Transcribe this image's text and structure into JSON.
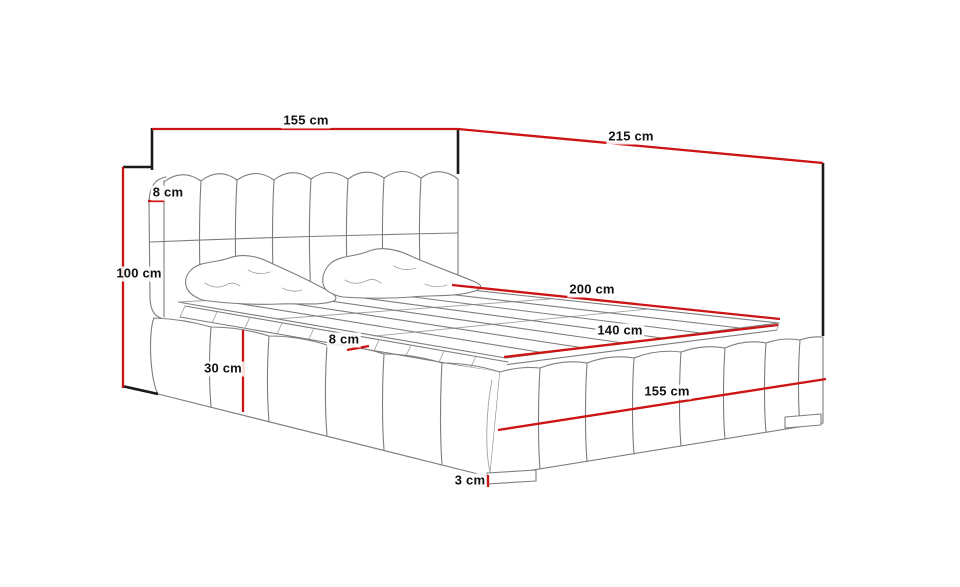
{
  "diagram": {
    "subject": "upholstered-bed-technical-dimension-drawing",
    "unit": "cm",
    "colors": {
      "background": "#ffffff",
      "dimension_line": "#cc1414",
      "tick": "#1a1a1a",
      "artwork": "#7d7d7d",
      "label_text": "#111111"
    },
    "dimensions": [
      {
        "name": "headboard-width",
        "label": "155 cm"
      },
      {
        "name": "overall-depth",
        "label": "215 cm"
      },
      {
        "name": "headboard-thickness",
        "label": "8 cm"
      },
      {
        "name": "headboard-height",
        "label": "100 cm"
      },
      {
        "name": "sleeping-area-length",
        "label": "200 cm"
      },
      {
        "name": "sleeping-area-width",
        "label": "140 cm"
      },
      {
        "name": "side-rail-thickness",
        "label": "8 cm"
      },
      {
        "name": "frame-height",
        "label": "30 cm"
      },
      {
        "name": "bed-width",
        "label": "155 cm"
      },
      {
        "name": "leg-height",
        "label": "3 cm"
      }
    ]
  }
}
